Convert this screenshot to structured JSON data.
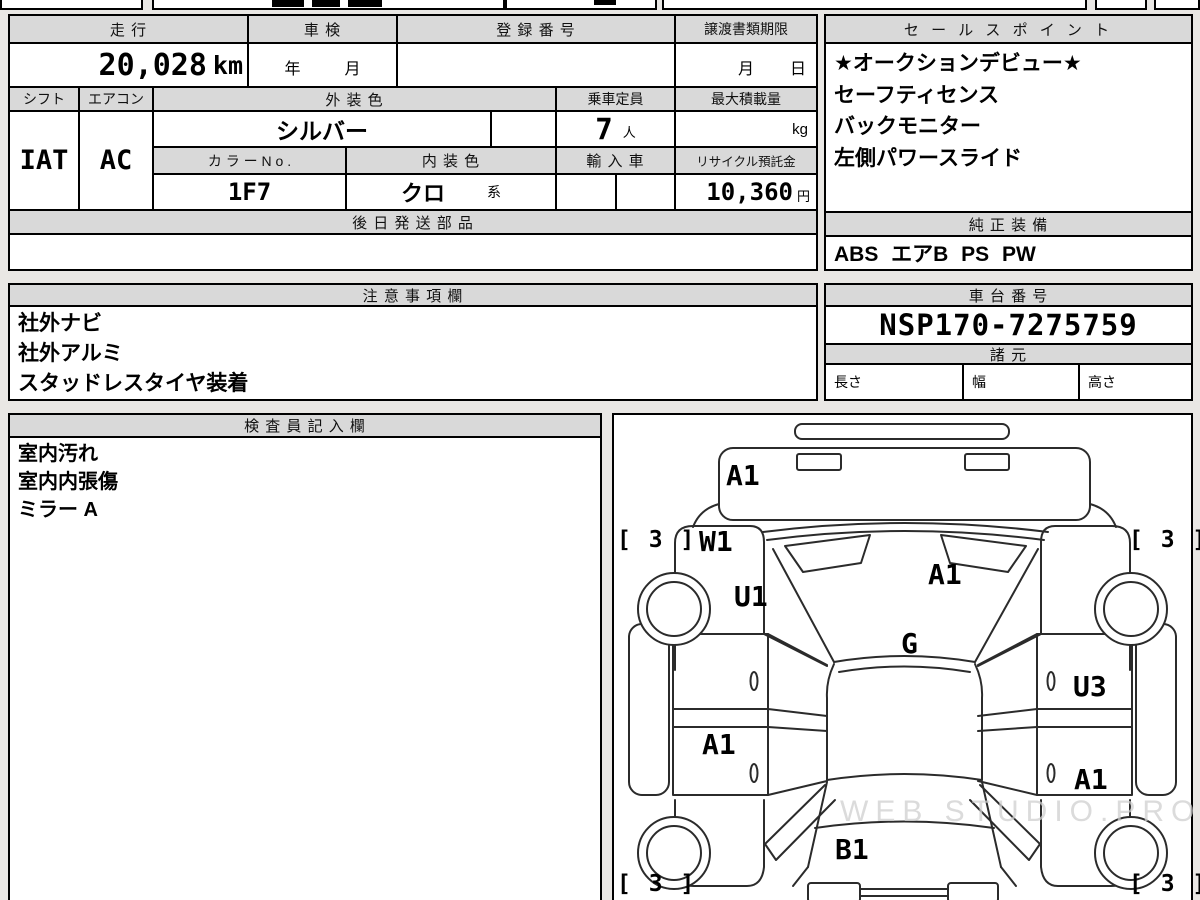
{
  "top_table": {
    "mileage_label": "走 行",
    "mileage_value": "20,028",
    "mileage_unit": "km",
    "shaken_label": "車 検",
    "shaken_year": "年",
    "shaken_month": "月",
    "registration_label": "登 録 番 号",
    "registration_value": "",
    "transfer_label": "譲渡書類期限",
    "transfer_month": "月",
    "transfer_day": "日",
    "shift_label": "シフト",
    "shift_value": "IAT",
    "aircon_label": "エアコン",
    "aircon_value": "AC",
    "exterior_label": "外 装 色",
    "exterior_value": "シルバー",
    "capacity_label": "乗車定員",
    "capacity_value": "7",
    "capacity_unit": "人",
    "maxload_label": "最大積載量",
    "maxload_value": "",
    "maxload_unit": "kg",
    "colorno_label": "カ ラ ー N o .",
    "colorno_value": "1F7",
    "interior_label": "内 装 色",
    "interior_value": "クロ",
    "interior_suffix": "系",
    "import_label": "輸 入 車",
    "recycle_label": "リサイクル預託金",
    "recycle_value": "10,360",
    "recycle_unit": "円",
    "later_parts_label": "後 日 発 送 部 品",
    "later_parts_value": ""
  },
  "sales": {
    "title": "セ ー ル ス ポ イ ン ト",
    "items": [
      "★オークションデビュー★",
      "セーフティセンス",
      "バックモニター",
      "左側パワースライド"
    ]
  },
  "equipment": {
    "title": "純 正 装 備",
    "value": "ABS エアB PS PW"
  },
  "notes": {
    "title": "注 意 事 項 欄",
    "items": [
      "社外ナビ",
      "社外アルミ",
      "スタッドレスタイヤ装着"
    ]
  },
  "chassis": {
    "title": "車 台 番 号",
    "number": "NSP170-7275759"
  },
  "specs": {
    "title": "諸 元",
    "length_label": "長さ",
    "width_label": "幅",
    "height_label": "高さ",
    "length_value": "",
    "width_value": "",
    "height_value": ""
  },
  "inspector": {
    "title": "検 査 員 記 入 欄",
    "items": [
      "室内汚れ",
      "室内内張傷",
      "ミラー A"
    ]
  },
  "diagram": {
    "labels": {
      "front_bumper": "A1",
      "left_fender": "W1",
      "left_front_door": "U1",
      "windshield": "A1",
      "cowl": "G",
      "left_slide_door": "A1",
      "right_front_door": "U3",
      "right_slide_door": "A1",
      "rear_gate": "B1"
    },
    "tire_mark": "[ 3 ]",
    "watermark": "WEB STUDIO.PRO"
  },
  "colors": {
    "header_bg": "#d9d9d9",
    "border": "#000000",
    "page_bg": "#e9e7e4"
  }
}
